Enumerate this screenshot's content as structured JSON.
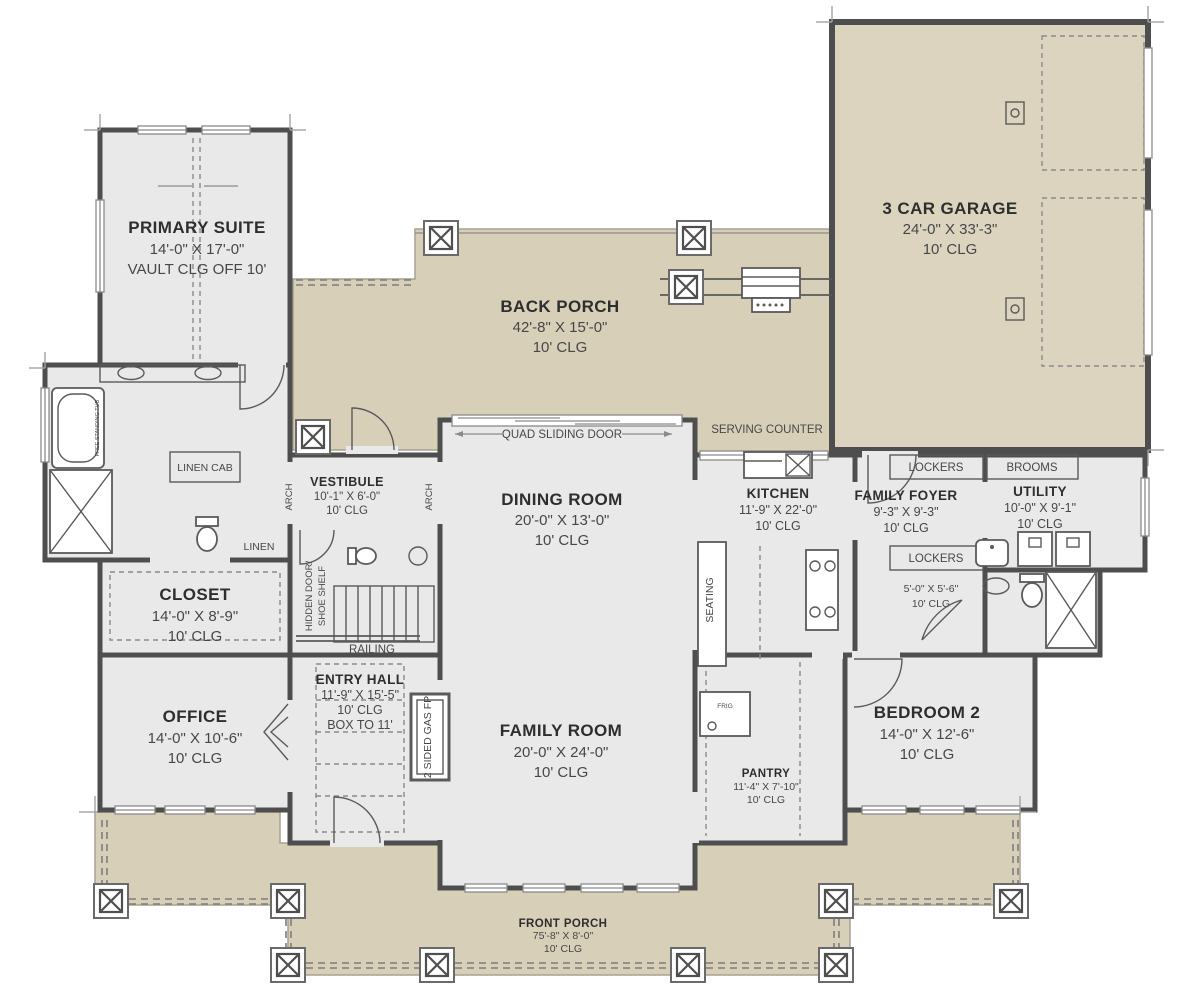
{
  "colors": {
    "porch_fill": "#d8cfb9",
    "garage_fill": "#ddd4c0",
    "room_fill": "#e9e9e9",
    "wall": "#4e4e4e",
    "text": "#3c3c3c"
  },
  "rooms": {
    "primary_suite": {
      "name": "PRIMARY SUITE",
      "dims": "14'-0\" X 17'-0\"",
      "clg": "VAULT CLG OFF 10'"
    },
    "back_porch": {
      "name": "BACK PORCH",
      "dims": "42'-8\" X 15'-0\"",
      "clg": "10' CLG"
    },
    "garage": {
      "name": "3 CAR GARAGE",
      "dims": "24'-0\" X 33'-3\"",
      "clg": "10' CLG"
    },
    "vestibule": {
      "name": "VESTIBULE",
      "dims": "10'-1\" X 6'-0\"",
      "clg": "10' CLG"
    },
    "dining_room": {
      "name": "DINING ROOM",
      "dims": "20'-0\" X 13'-0\"",
      "clg": "10' CLG"
    },
    "kitchen": {
      "name": "KITCHEN",
      "dims": "11'-9\" X 22'-0\"",
      "clg": "10' CLG"
    },
    "family_foyer": {
      "name": "FAMILY FOYER",
      "dims": "9'-3\" X 9'-3\"",
      "clg": "10' CLG"
    },
    "utility": {
      "name": "UTILITY",
      "dims": "10'-0\" X 9'-1\"",
      "clg": "10' CLG"
    },
    "closet": {
      "name": "CLOSET",
      "dims": "14'-0\" X 8'-9\"",
      "clg": "10' CLG"
    },
    "office": {
      "name": "OFFICE",
      "dims": "14'-0\" X 10'-6\"",
      "clg": "10' CLG"
    },
    "entry_hall": {
      "name": "ENTRY HALL",
      "dims": "11'-9\" X 15'-5\"",
      "clg": "10' CLG",
      "extra": "BOX TO 11'"
    },
    "family_room": {
      "name": "FAMILY ROOM",
      "dims": "20'-0\" X 24'-0\"",
      "clg": "10' CLG"
    },
    "pantry": {
      "name": "PANTRY",
      "dims": "11'-4\" X 7'-10\"",
      "clg": "10' CLG"
    },
    "bedroom_2": {
      "name": "BEDROOM 2",
      "dims": "14'-0\" X 12'-6\"",
      "clg": "10' CLG"
    },
    "front_porch": {
      "name": "FRONT PORCH",
      "dims": "75'-8\" X 8'-0\"",
      "clg": "10' CLG"
    },
    "mud_closet": {
      "dims": "5'-0\" X 5'-6\"",
      "clg": "10' CLG"
    }
  },
  "annotations": {
    "quad_sliding_door": "QUAD SLIDING DOOR",
    "serving_counter": "SERVING COUNTER",
    "lockers_top": "LOCKERS",
    "brooms": "BROOMS",
    "lockers_bottom": "LOCKERS",
    "linen_cab": "LINEN CAB",
    "linen": "LINEN",
    "arch_left": "ARCH",
    "arch_right": "ARCH",
    "railing": "RAILING",
    "hidden_door_line1": "HIDDEN DOOR/",
    "hidden_door_line2": "SHOE SHELF",
    "gas_fireplace": "2 SIDED GAS FP",
    "seating": "SEATING",
    "free_standing_tub": "FREE STANDING TUB",
    "fridge": "FRIG"
  }
}
